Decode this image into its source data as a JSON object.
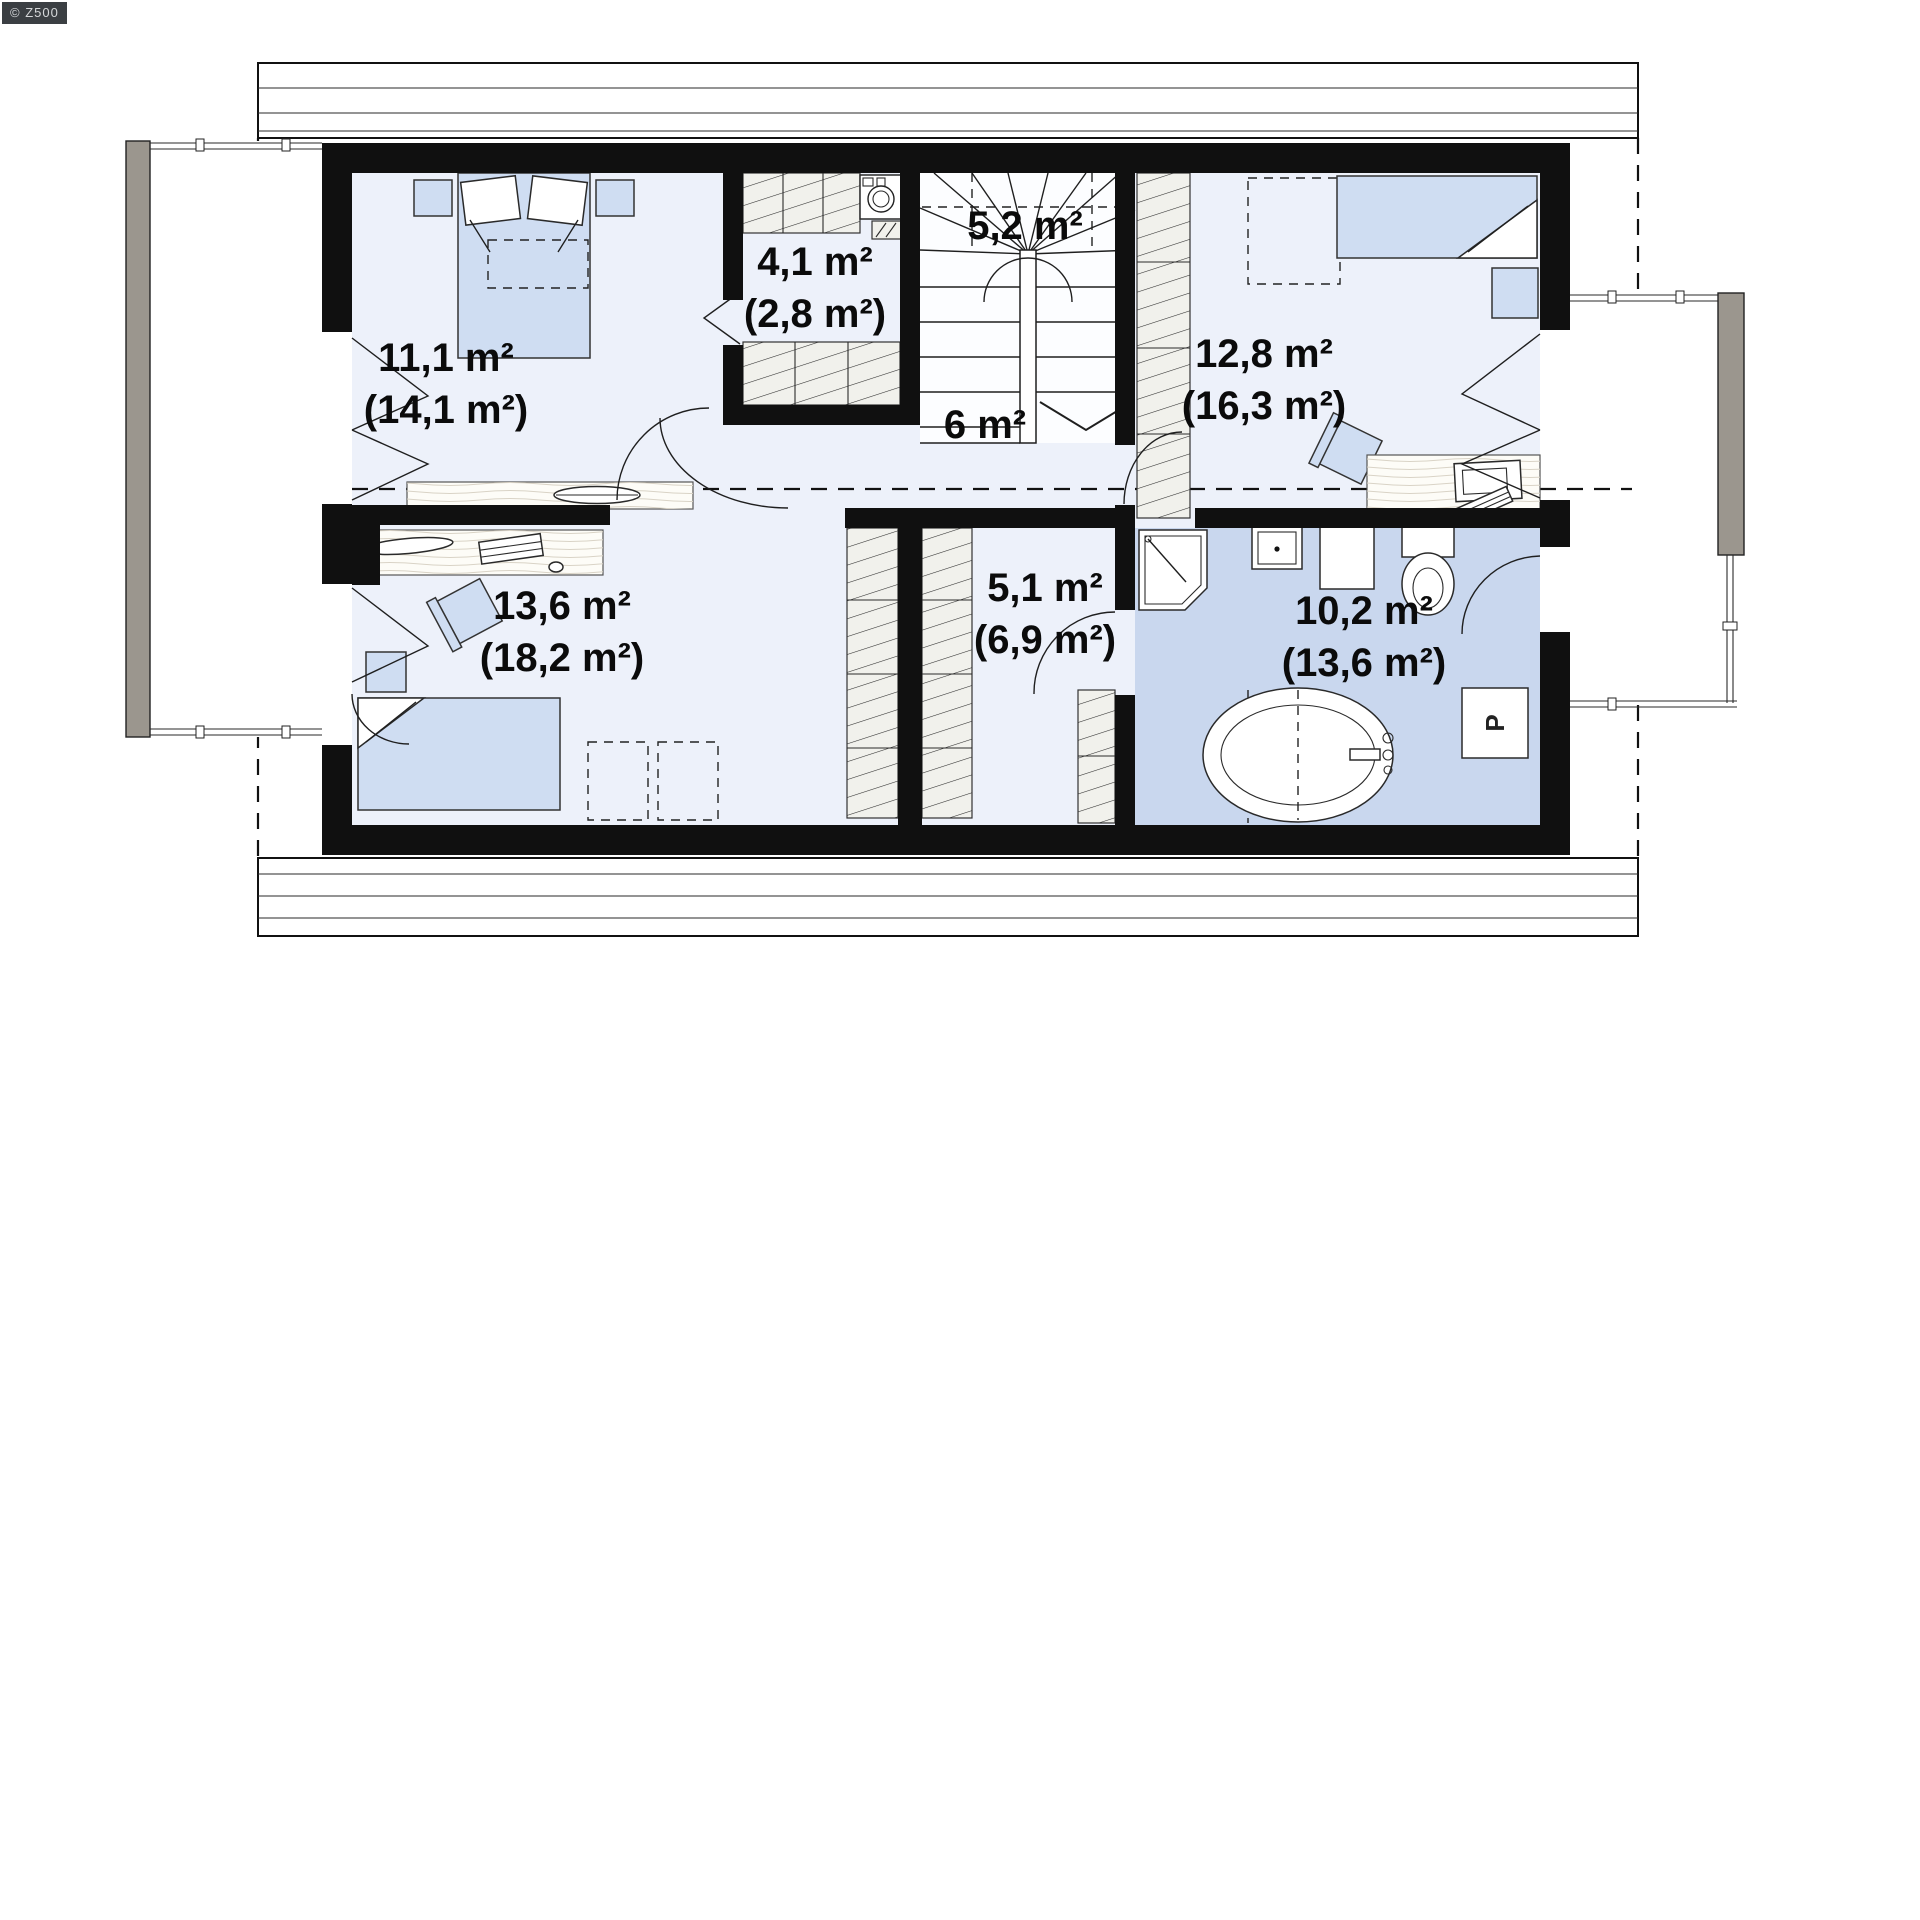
{
  "watermark": {
    "text": "© Z500"
  },
  "colors": {
    "wall-color": "#101010",
    "room-color": "#edf1fa",
    "bathroom-color": "#c9d7ee",
    "furniture-color": "#cfddf2",
    "railing-color": "#9b968e"
  },
  "plan": {
    "type": "attic floor plan",
    "rooms": [
      {
        "id": "bedroom-1",
        "area": "11,1 m²",
        "area_attic": "(14,1 m²)"
      },
      {
        "id": "wardrobe",
        "area": "4,1 m²",
        "area_attic": "(2,8 m²)"
      },
      {
        "id": "staircase",
        "area": "5,2 m²",
        "area_attic": ""
      },
      {
        "id": "hallway",
        "area": "6 m²",
        "area_attic": ""
      },
      {
        "id": "bedroom-2",
        "area": "12,8 m²",
        "area_attic": "(16,3 m²)"
      },
      {
        "id": "bedroom-3",
        "area": "13,6 m²",
        "area_attic": "(18,2 m²)"
      },
      {
        "id": "closet",
        "area": "5,1 m²",
        "area_attic": "(6,9 m²)"
      },
      {
        "id": "bathroom",
        "area": "10,2 m²",
        "area_attic": "(13,6 m²)"
      }
    ],
    "appliances": {
      "washing_machine_label": "P"
    }
  }
}
